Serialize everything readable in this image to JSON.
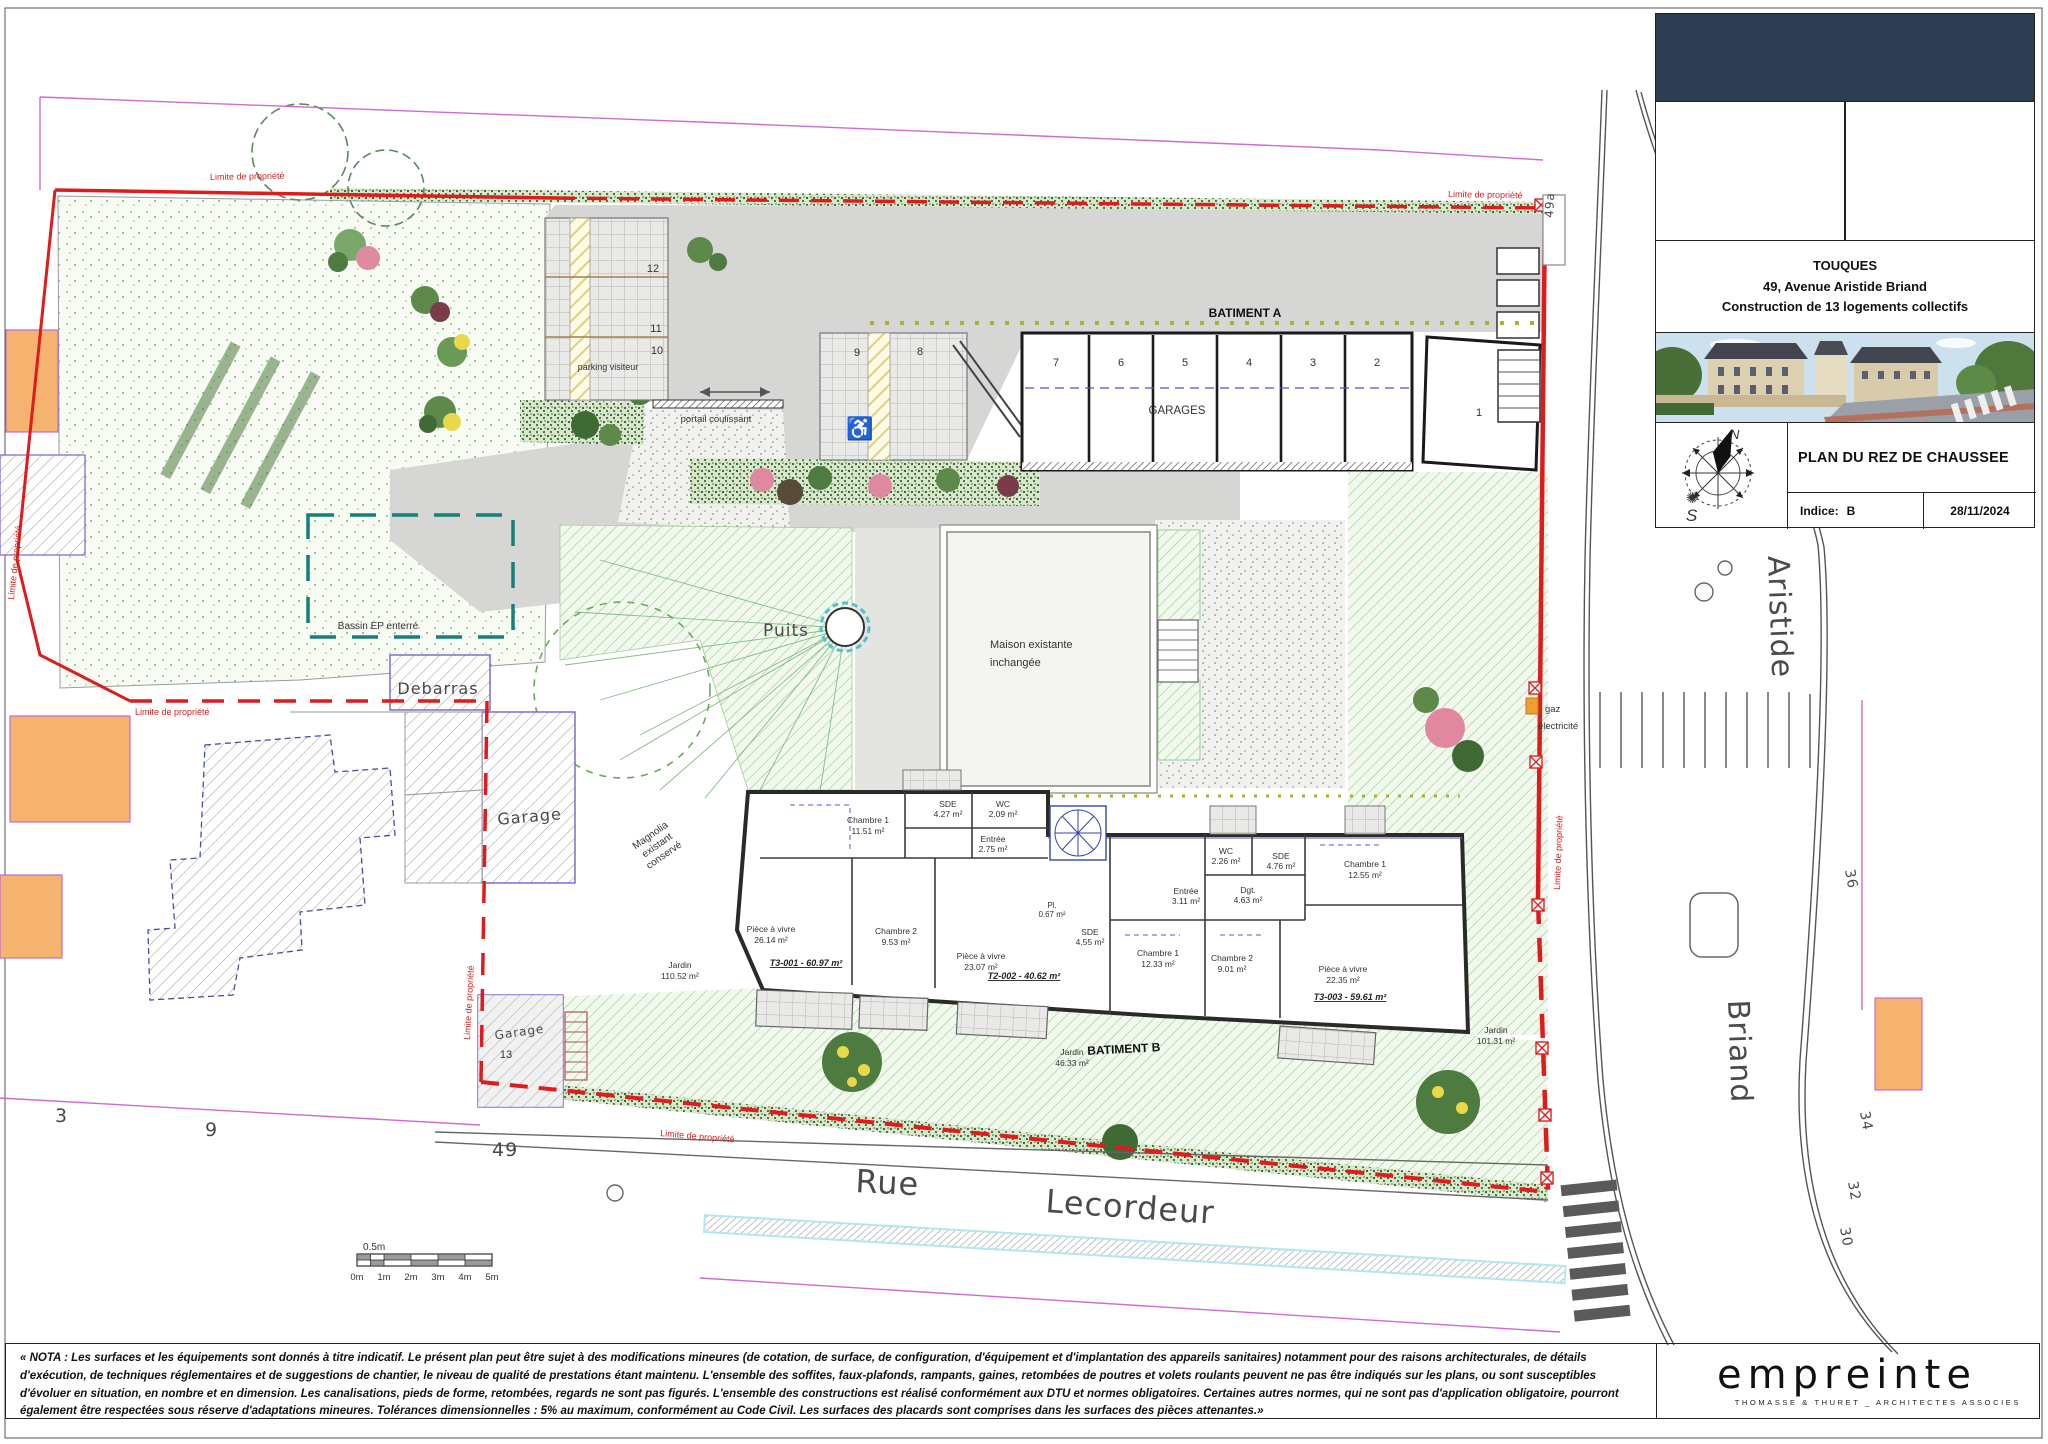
{
  "sheet": {
    "title_block": {
      "city": "TOUQUES",
      "address": "49, Avenue Aristide Briand",
      "project": "Construction de 13 logements collectifs",
      "drawing_title": "PLAN DU REZ DE CHAUSSEE",
      "indice_label": "Indice:",
      "indice_value": "B",
      "date": "28/11/2024",
      "compass_n": "N",
      "compass_s": "S"
    },
    "nota": "« NOTA : Les surfaces et les équipements sont donnés à titre indicatif. Le présent plan peut être sujet à des modifications mineures (de cotation, de surface, de configuration, d'équipement et d'implantation des appareils sanitaires) notamment pour des raisons architecturales, de détails d'exécution, de techniques réglementaires et de suggestions de chantier, le niveau de qualité de prestations étant maintenu. L'ensemble des soffites, faux-plafonds, rampants, gaines, retombées de poutres et volets roulants peuvent ne pas être indiqués sur les plans, ou sont susceptibles d'évoluer en situation, en nombre et en dimension. Les canalisations, pieds de forme, retombées, regards ne sont pas figurés. L'ensemble des constructions est réalisé conformément aux DTU et normes obligatoires. Certaines autres normes, qui ne sont pas d'application obligatoire, pourront également être respectées sous réserve d'adaptations mineures. Tolérances dimensionnelles : 5% au maximum, conformément au Code Civil. Les surfaces des placards sont comprises dans les surfaces des pièces attenantes.»",
    "logo": {
      "name": "empreinte",
      "subtitle": "THOMASSE & THURET _ ARCHITECTES ASSOCIES"
    }
  },
  "plan": {
    "buildings": {
      "batiment_a": "BATIMENT A",
      "batiment_b": "BATIMENT B",
      "garages": "GARAGES",
      "maison_1": "Maison existante",
      "maison_2": "inchangée",
      "debarras": "Debarras",
      "garage": "Garage",
      "garage13_label": "Garage",
      "garage13_num": "13"
    },
    "labels": {
      "puits": "Puits",
      "bassin": "Bassin EP enterré",
      "parking_visiteur": "parking visiteur",
      "portail": "portail coulissant",
      "limite": "Limite de propriété",
      "gaz": "gaz",
      "electricite": "électricité",
      "magnolia_1": "Magnolia",
      "magnolia_2": "existant",
      "magnolia_3": "conservé"
    },
    "garage_numbers": [
      "7",
      "6",
      "5",
      "4",
      "3",
      "2",
      "1"
    ],
    "parking_numbers": [
      "12",
      "11",
      "10",
      "9",
      "8"
    ],
    "units": [
      "T3-001 - 60.97 m²",
      "T2-002 - 40.62 m²",
      "T3-003 - 59.61 m²"
    ],
    "rooms": [
      {
        "name": "Chambre 1",
        "area": "11.51 m²"
      },
      {
        "name": "SDE",
        "area": "4.27 m²"
      },
      {
        "name": "WC",
        "area": "2.09 m²"
      },
      {
        "name": "Entrée",
        "area": "2.75 m²"
      },
      {
        "name": "Pièce à vivre",
        "area": "26.14 m²"
      },
      {
        "name": "Chambre 2",
        "area": "9.53 m²"
      },
      {
        "name": "Pl.",
        "area": "0.67 m²"
      },
      {
        "name": "Pièce à vivre",
        "area": "23.07 m²"
      },
      {
        "name": "WC",
        "area": "2.26 m²"
      },
      {
        "name": "SDE",
        "area": "4.76 m²"
      },
      {
        "name": "Entrée",
        "area": "3.11 m²"
      },
      {
        "name": "Dgt.",
        "area": "4.63 m²"
      },
      {
        "name": "Chambre 1",
        "area": "12.55 m²"
      },
      {
        "name": "SDE",
        "area": "4.55 m²"
      },
      {
        "name": "Chambre 1",
        "area": "12.33 m²"
      },
      {
        "name": "Chambre 2",
        "area": "9.01 m²"
      },
      {
        "name": "Pièce à vivre",
        "area": "22.35 m²"
      }
    ],
    "gardens": [
      {
        "name": "Jardin",
        "area": "110.52 m²"
      },
      {
        "name": "Jardin",
        "area": "46.33 m²"
      },
      {
        "name": "Jardin",
        "area": "101.31 m²"
      }
    ],
    "streets": {
      "rue": "Rue",
      "lecordeur": "Lecordeur",
      "aristide": "Aristide",
      "briand": "Briand"
    },
    "parcels": {
      "n3": "3",
      "n9": "9",
      "n49": "49",
      "n49a": "49a",
      "n36": "36",
      "n34": "34",
      "n32": "32",
      "n30": "30"
    },
    "scale": {
      "half": "0.5m",
      "t0": "0m",
      "t1": "1m",
      "t2": "2m",
      "t3": "3m",
      "t4": "4m",
      "t5": "5m"
    }
  }
}
